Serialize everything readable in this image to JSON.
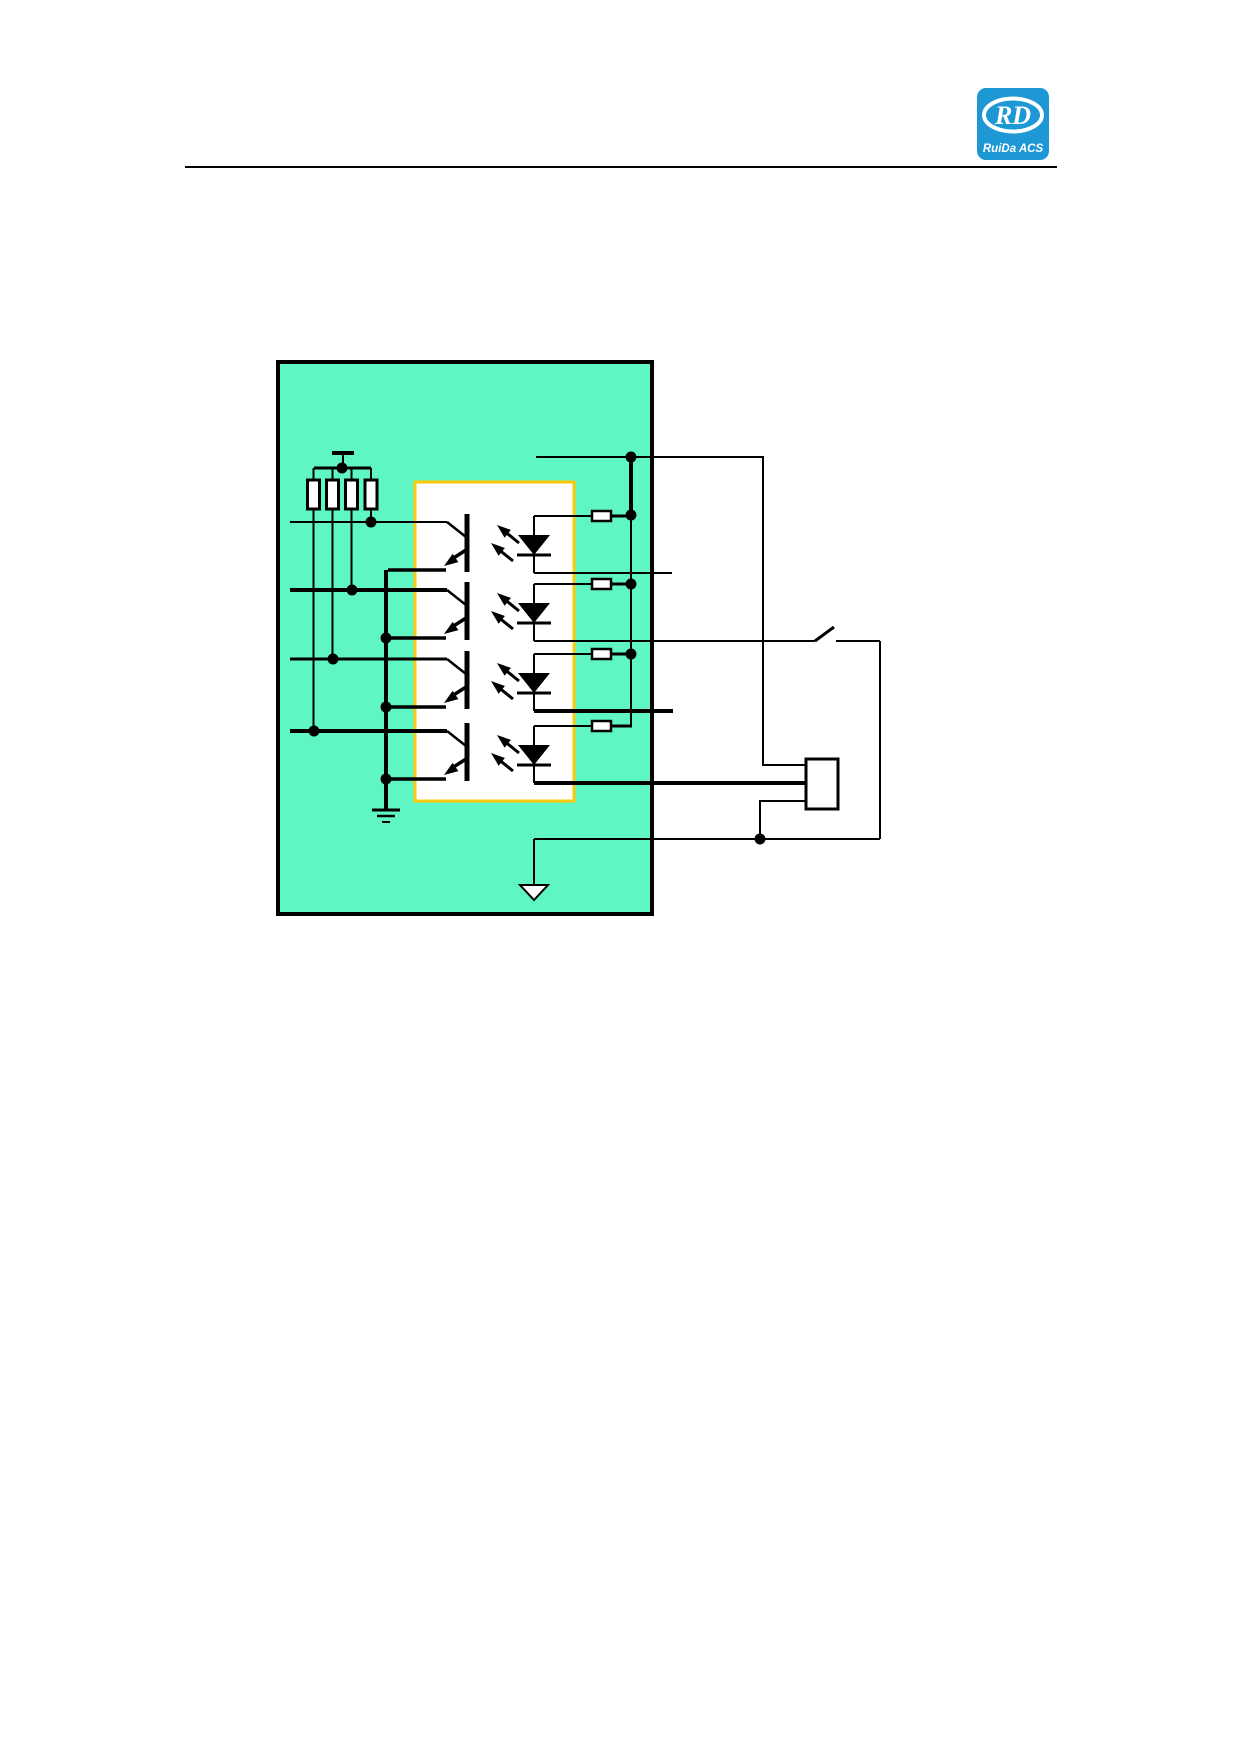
{
  "colors": {
    "logo_blue": "#1E97D5",
    "board_fill": "#5FF6C4",
    "ic_border": "#FFC80A",
    "wire": "#000000"
  },
  "header": {
    "logo": {
      "monogram": "RD",
      "caption": "RuiDa ACS"
    }
  },
  "diagram": {
    "channels": 4,
    "icons": [
      "power-rail-icon",
      "pullup-resistor-icon",
      "optocoupler-ic-box",
      "phototransistor-icon",
      "led-icon",
      "light-arrows-icon",
      "series-resistor-icon",
      "junction-dot",
      "switch-icon",
      "device-box",
      "chassis-ground-icon",
      "signal-ground-arrow-icon"
    ]
  }
}
